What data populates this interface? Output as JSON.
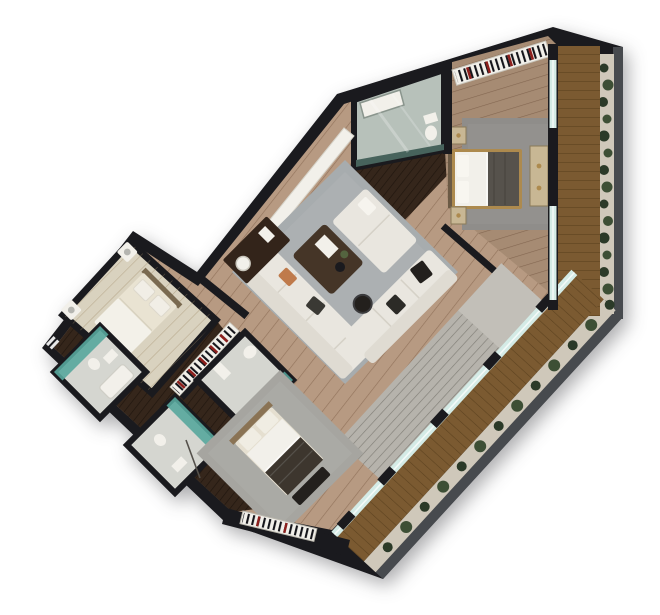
{
  "image": {
    "kind": "3d-rendered-top-down-floor-plan",
    "width_px": 660,
    "height_px": 615,
    "background": "#ffffff"
  },
  "palette": {
    "wall": "#1a1a1e",
    "parapet": "#474a4e",
    "gravel": "#cfc8ba",
    "plantDark": "#2b3a28",
    "plantLight": "#3d4f35",
    "deck": "#7b5a31",
    "deckLine": "#5d421f",
    "floorMain": "#b79a82",
    "floorMaster": "#a68b73",
    "walnut": "#35261b",
    "wingFloor": "#d9d2bf",
    "rugLiving": "#a7acae",
    "rugMaster": "#8f8d8a",
    "rugBottom": "#a6a5a0",
    "sofaCream": "#e9e6df",
    "white": "#f2f0ea",
    "glassBox": "#b7c1ba",
    "glassLine": "#d4ebe6",
    "teal": "#58a79c",
    "tealDark": "#47635c",
    "bathFloor": "#d5d6d0",
    "stairs": "#b6b3ac",
    "stairsLight": "#c2bfb8",
    "gold": "#ad8a4e",
    "tan": "#c8b794",
    "blanketMaster": "#56524c",
    "blanketBottom": "#3d362e",
    "tableDark": "#453527",
    "sideboard": "#33241a",
    "accentOrange": "#bf7a4b",
    "barcodeRed": "#8d1f1c"
  },
  "elements": [
    "master-bedroom",
    "ensuite-glass-bathroom",
    "wardrobe-strip",
    "living-room",
    "sectional-sofa",
    "coffee-table",
    "sideboard",
    "staircase",
    "glass-wall",
    "wood-terrace",
    "planter-strip",
    "wing-bedroom",
    "piano-keys-strip",
    "bathroom-a",
    "bathroom-b",
    "bathroom-c",
    "bottom-bedroom",
    "radiator-strip",
    "balcony-right",
    "corridor"
  ]
}
